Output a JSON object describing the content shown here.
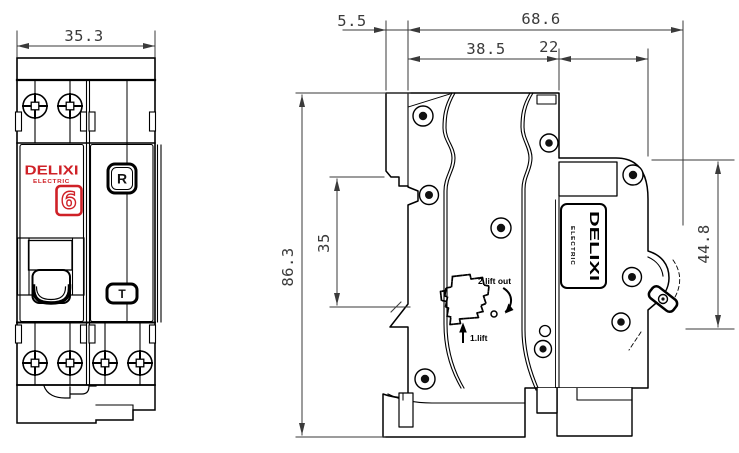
{
  "colors": {
    "brand_red": "#cf2127",
    "line": "#000000",
    "dim": "#3a3a3a"
  },
  "front_view": {
    "dim_width": "35.3",
    "brand": "DELIXI",
    "brand_sub": "ELECTRIC",
    "rating_badge": "6",
    "reset_button_label": "R",
    "test_button_label": "T"
  },
  "side_view": {
    "dim_tab_depth": "5.5",
    "dim_total_depth": "68.6",
    "dim_body_depth": "38.5",
    "dim_front_depth": "22",
    "dim_total_height": "86.3",
    "dim_rail_offset": "35",
    "dim_front_height": "44.8",
    "label_brand": "DELIXI",
    "label_brand_sub": "ELECTRIC",
    "instruction_step_1": "1.lift",
    "instruction_step_2": "2.lift out"
  }
}
